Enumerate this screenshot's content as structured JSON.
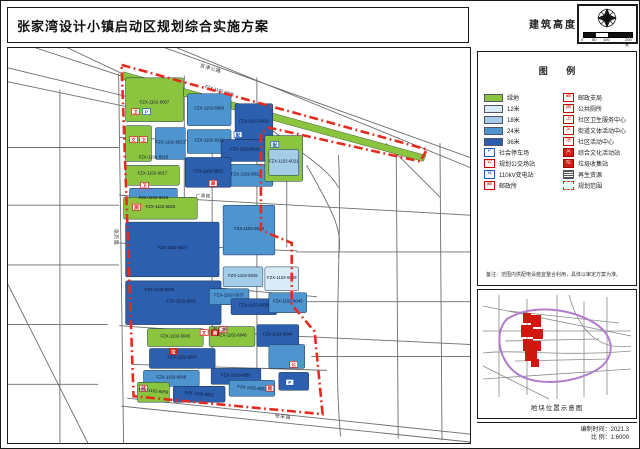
{
  "title": "张家湾设计小镇启动区规划综合实施方案",
  "header": {
    "map_type_label": "建筑高度",
    "scale_ticks": [
      "0",
      "50",
      "100",
      "200米"
    ]
  },
  "legend": {
    "title": "图  例",
    "left": [
      {
        "label": "绿地",
        "swatch": "g"
      },
      {
        "label": "12米",
        "swatch": "h12"
      },
      {
        "label": "18米",
        "swatch": "h18"
      },
      {
        "label": "24米",
        "swatch": "h24"
      },
      {
        "label": "36米",
        "swatch": "h36"
      },
      {
        "label": "社会停车场",
        "icon": "P",
        "style": "blue"
      },
      {
        "label": "规划公交场站",
        "icon": "公",
        "style": "red"
      },
      {
        "label": "110kV变电站",
        "icon": "变",
        "style": "blue"
      },
      {
        "label": "邮政所",
        "icon": "邮",
        "style": "red"
      }
    ],
    "right": [
      {
        "label": "邮政支局",
        "icon": "邮",
        "style": "red"
      },
      {
        "label": "公共厕所",
        "icon": "厕",
        "style": "red"
      },
      {
        "label": "社区卫生服务中心",
        "icon": "卫",
        "style": "red"
      },
      {
        "label": "街道文体活动中心",
        "icon": "文",
        "style": "red"
      },
      {
        "label": "社区活动中心",
        "icon": "活",
        "style": "red"
      },
      {
        "label": "综合文化活动站",
        "icon": "文",
        "style": "red-filled"
      },
      {
        "label": "垃圾收集站",
        "icon": "垃",
        "style": "red-filled"
      },
      {
        "label": "再生资源",
        "icon": "",
        "style": "hatch"
      },
      {
        "label": "规划范围",
        "icon": "",
        "style": "dash"
      }
    ]
  },
  "note": "备注：范围内供配电设施宜整合利用，具体以审定方案为准。",
  "inset": {
    "caption": "地块位置示意图"
  },
  "footer": {
    "date_label": "编制时间：2021.3",
    "scale_label": "比  例：1:6000"
  },
  "colors": {
    "g": "#8bc53f",
    "h12": "#d9ebf7",
    "h18": "#a3cce8",
    "h24": "#4e95d0",
    "h36": "#2c5fae",
    "red": "#d21e14",
    "blue": "#1a57c4",
    "boundary": "#e62b1e"
  },
  "map": {
    "green_strip": "116,24 420,108 417,114 113,31",
    "boundary": "114,17 421,102 414,114 262,80 254,86 254,183 285,196 285,258 308,285 316,368 126,350",
    "blocks": [
      {
        "x": 118,
        "y": 30,
        "w": 58,
        "h": 44,
        "c": "g"
      },
      {
        "x": 180,
        "y": 46,
        "w": 44,
        "h": 32,
        "c": "h24"
      },
      {
        "x": 228,
        "y": 56,
        "w": 38,
        "h": 36,
        "c": "h36"
      },
      {
        "x": 180,
        "y": 82,
        "w": 44,
        "h": 24,
        "c": "h24"
      },
      {
        "x": 118,
        "y": 78,
        "w": 26,
        "h": 36,
        "c": "g"
      },
      {
        "x": 148,
        "y": 80,
        "w": 30,
        "h": 32,
        "c": "h24"
      },
      {
        "x": 118,
        "y": 118,
        "w": 54,
        "h": 20,
        "c": "g"
      },
      {
        "x": 122,
        "y": 141,
        "w": 48,
        "h": 24,
        "c": "h24"
      },
      {
        "x": 214,
        "y": 92,
        "w": 48,
        "h": 22,
        "c": "h36"
      },
      {
        "x": 212,
        "y": 117,
        "w": 54,
        "h": 22,
        "c": "h24"
      },
      {
        "x": 178,
        "y": 110,
        "w": 46,
        "h": 30,
        "c": "h36"
      },
      {
        "x": 258,
        "y": 88,
        "w": 38,
        "h": 46,
        "c": "g"
      },
      {
        "x": 262,
        "y": 102,
        "w": 30,
        "h": 26,
        "c": "h18"
      },
      {
        "x": 116,
        "y": 150,
        "w": 74,
        "h": 22,
        "c": "g"
      },
      {
        "x": 118,
        "y": 175,
        "w": 94,
        "h": 55,
        "c": "h36"
      },
      {
        "x": 216,
        "y": 158,
        "w": 52,
        "h": 50,
        "c": "h24"
      },
      {
        "x": 118,
        "y": 234,
        "w": 96,
        "h": 44,
        "c": "h36"
      },
      {
        "x": 216,
        "y": 220,
        "w": 40,
        "h": 20,
        "c": "h18"
      },
      {
        "x": 258,
        "y": 220,
        "w": 34,
        "h": 24,
        "c": "h12"
      },
      {
        "x": 202,
        "y": 242,
        "w": 40,
        "h": 16,
        "c": "h24"
      },
      {
        "x": 224,
        "y": 252,
        "w": 46,
        "h": 16,
        "c": "h36"
      },
      {
        "x": 262,
        "y": 246,
        "w": 38,
        "h": 20,
        "c": "h24"
      },
      {
        "x": 250,
        "y": 278,
        "w": 42,
        "h": 22,
        "c": "h36"
      },
      {
        "x": 140,
        "y": 282,
        "w": 56,
        "h": 18,
        "c": "g"
      },
      {
        "x": 202,
        "y": 280,
        "w": 46,
        "h": 20,
        "c": "g"
      },
      {
        "x": 142,
        "y": 302,
        "w": 66,
        "h": 20,
        "c": "h36"
      },
      {
        "x": 136,
        "y": 324,
        "w": 56,
        "h": 16,
        "c": "h24"
      },
      {
        "x": 204,
        "y": 322,
        "w": 50,
        "h": 16,
        "c": "h36"
      },
      {
        "x": 262,
        "y": 298,
        "w": 36,
        "h": 24,
        "c": "h24"
      },
      {
        "x": 130,
        "y": 336,
        "w": 32,
        "h": 20,
        "c": "g"
      },
      {
        "x": 166,
        "y": 340,
        "w": 52,
        "h": 16,
        "c": "h36"
      },
      {
        "x": 222,
        "y": 334,
        "w": 46,
        "h": 16,
        "c": "h24"
      },
      {
        "x": 272,
        "y": 326,
        "w": 30,
        "h": 18,
        "c": "h36"
      }
    ],
    "labels": [
      {
        "t": "FZX-1102-6007",
        "x": 147,
        "y": 56
      },
      {
        "t": "FZX-1102-6006",
        "x": 212,
        "y": 44,
        "r": 16
      },
      {
        "t": "FZX-1102-6009",
        "x": 202,
        "y": 62
      },
      {
        "t": "FZX-1102-6010",
        "x": 247,
        "y": 75
      },
      {
        "t": "FZX-1102-6011",
        "x": 202,
        "y": 94
      },
      {
        "t": "FZX-1102-6013",
        "x": 163,
        "y": 96
      },
      {
        "t": "FZX-1102-6015",
        "x": 146,
        "y": 111
      },
      {
        "t": "FZX-1102-6017",
        "x": 145,
        "y": 127
      },
      {
        "t": "FZX-1102-6018",
        "x": 146,
        "y": 152
      },
      {
        "t": "FZX-1102-6014",
        "x": 238,
        "y": 103
      },
      {
        "t": "FZX-1102-6022",
        "x": 239,
        "y": 128
      },
      {
        "t": "FZX-1102-6023",
        "x": 201,
        "y": 125
      },
      {
        "t": "FZX-1102-6021",
        "x": 277,
        "y": 115
      },
      {
        "t": "FZX-1102-6026",
        "x": 153,
        "y": 161
      },
      {
        "t": "FZX-1102-6027",
        "x": 165,
        "y": 202
      },
      {
        "t": "FZX-1102-6028",
        "x": 242,
        "y": 183
      },
      {
        "t": "FZX-1102-6030",
        "x": 152,
        "y": 244
      },
      {
        "t": "FZX-1102-6031",
        "x": 174,
        "y": 256
      },
      {
        "t": "FZX-1102-6036",
        "x": 236,
        "y": 230
      },
      {
        "t": "FZX-1102-6039",
        "x": 275,
        "y": 232
      },
      {
        "t": "FZX-1102-6037",
        "x": 222,
        "y": 250
      },
      {
        "t": "FZX-1102-6038",
        "x": 247,
        "y": 260
      },
      {
        "t": "FZX-1102-6043",
        "x": 281,
        "y": 256
      },
      {
        "t": "FZX-1102-6044",
        "x": 271,
        "y": 289
      },
      {
        "t": "FZX-1102-6045",
        "x": 168,
        "y": 291
      },
      {
        "t": "FZX-1102-6046",
        "x": 225,
        "y": 290
      },
      {
        "t": "FZX-1102-6047",
        "x": 175,
        "y": 312
      },
      {
        "t": "FZX-1102-6048",
        "x": 164,
        "y": 332
      },
      {
        "t": "FZX-1102-6050",
        "x": 229,
        "y": 330
      },
      {
        "t": "FZX-1102-6053",
        "x": 245,
        "y": 343,
        "r": 6
      },
      {
        "t": "FZX-1102-6052",
        "x": 192,
        "y": 349,
        "r": 6
      },
      {
        "t": "FZX-1102-6056",
        "x": 146,
        "y": 346,
        "r": 6
      }
    ],
    "roadnames": [
      {
        "t": "京津公路",
        "x": 203,
        "y": 22,
        "r": 16,
        "s": 5
      },
      {
        "t": "张凤路",
        "x": 107,
        "y": 190,
        "r": 90,
        "s": 5
      },
      {
        "t": "广源路",
        "x": 196,
        "y": 150,
        "r": 2,
        "s": 4.5
      },
      {
        "t": "宏仁路",
        "x": 213,
        "y": 284,
        "r": 3,
        "s": 4.5
      },
      {
        "t": "张采路",
        "x": 276,
        "y": 372,
        "r": 7,
        "s": 5
      }
    ],
    "icons": [
      {
        "g": "卫",
        "c": "r",
        "x": 128,
        "y": 64
      },
      {
        "g": "P",
        "c": "b",
        "x": 139,
        "y": 64
      },
      {
        "g": "文",
        "c": "r",
        "x": 126,
        "y": 92
      },
      {
        "g": "卫",
        "c": "r",
        "x": 136,
        "y": 92
      },
      {
        "g": "配",
        "c": "b",
        "x": 231,
        "y": 87
      },
      {
        "g": "邮",
        "c": "r",
        "x": 206,
        "y": 136
      },
      {
        "g": "卫",
        "c": "r",
        "x": 137,
        "y": 138
      },
      {
        "g": "厕",
        "c": "r",
        "x": 129,
        "y": 160
      },
      {
        "g": "配",
        "c": "b",
        "x": 268,
        "y": 97
      },
      {
        "g": "文",
        "c": "r",
        "x": 197,
        "y": 286
      },
      {
        "g": "商",
        "c": "rf",
        "x": 208,
        "y": 286
      },
      {
        "g": "卫",
        "c": "r",
        "x": 216,
        "y": 283
      },
      {
        "g": "垃",
        "c": "rf",
        "x": 166,
        "y": 305
      },
      {
        "g": "公",
        "c": "r",
        "x": 287,
        "y": 318
      },
      {
        "g": "厕",
        "c": "r",
        "x": 263,
        "y": 342
      },
      {
        "g": "邮",
        "c": "r",
        "x": 136,
        "y": 342
      },
      {
        "g": "P",
        "c": "b",
        "x": 283,
        "y": 336
      }
    ]
  }
}
